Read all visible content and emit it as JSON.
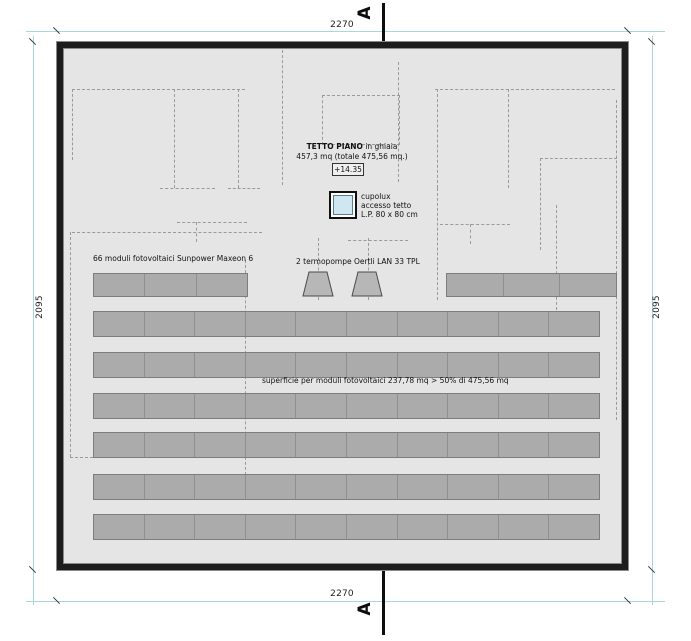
{
  "drawing": {
    "title_bold": "TETTO PIANO",
    "title_rest": " in ghiaia",
    "title_line2": "457,3 mq (totale 475,56 mq.)",
    "elevation": "+14.35",
    "skylight_label": [
      "cupolux",
      "accesso tetto",
      "L.P. 80 x 80 cm"
    ],
    "modules_note": "66 moduli fotovoltaici Sunpower Maxeon 6",
    "heatpump_note": "2 termopompe Oertli LAN 33 TPL",
    "surface_note": "superficie per moduli fotovoltaici 237,78 mq > 50% di  475,56 mq",
    "section_label": "A"
  },
  "dimensions": {
    "top": "2270",
    "bottom": "2270",
    "left": "2095",
    "right": "2095"
  },
  "colors": {
    "dimension_line": "#a9d6d6",
    "dashed_structure": "#9a9a9a",
    "panel_fill": "#ababab",
    "panel_border": "#7d7d7d",
    "roof_fill": "#e5e5e5",
    "wall": "#1d1d1d",
    "skylight_fill": "#cfe6f3"
  },
  "geometry": {
    "rows": [
      {
        "y": 273,
        "h": 24,
        "blocks": [
          {
            "x": 93,
            "w": 155,
            "panels": 3
          },
          {
            "x": 446,
            "w": 171,
            "panels": 3
          }
        ]
      },
      {
        "y": 311,
        "h": 26,
        "blocks": [
          {
            "x": 93,
            "w": 507,
            "panels": 10
          }
        ]
      },
      {
        "y": 352,
        "h": 26,
        "blocks": [
          {
            "x": 93,
            "w": 507,
            "panels": 10
          }
        ]
      },
      {
        "y": 393,
        "h": 26,
        "blocks": [
          {
            "x": 93,
            "w": 507,
            "panels": 10
          }
        ]
      },
      {
        "y": 432,
        "h": 26,
        "blocks": [
          {
            "x": 93,
            "w": 507,
            "panels": 10
          }
        ]
      },
      {
        "y": 474,
        "h": 26,
        "blocks": [
          {
            "x": 93,
            "w": 507,
            "panels": 10
          }
        ]
      },
      {
        "y": 514,
        "h": 26,
        "blocks": [
          {
            "x": 93,
            "w": 507,
            "panels": 10
          }
        ]
      }
    ],
    "dashes": [
      {
        "t": "h",
        "x": 72,
        "y": 89,
        "w": 173
      },
      {
        "t": "v",
        "x": 72,
        "y": 89,
        "h": 71
      },
      {
        "t": "v",
        "x": 174,
        "y": 89,
        "h": 99
      },
      {
        "t": "v",
        "x": 238,
        "y": 89,
        "h": 99
      },
      {
        "t": "h",
        "x": 160,
        "y": 188,
        "w": 55
      },
      {
        "t": "h",
        "x": 228,
        "y": 188,
        "w": 32
      },
      {
        "t": "v",
        "x": 282,
        "y": 50,
        "h": 135
      },
      {
        "t": "r",
        "x": 322,
        "y": 95,
        "w": 78,
        "h": 50
      },
      {
        "t": "v",
        "x": 398,
        "y": 62,
        "h": 120
      },
      {
        "t": "h",
        "x": 435,
        "y": 89,
        "w": 180
      },
      {
        "t": "v",
        "x": 437,
        "y": 89,
        "h": 99
      },
      {
        "t": "v",
        "x": 508,
        "y": 89,
        "h": 99
      },
      {
        "t": "h",
        "x": 540,
        "y": 158,
        "w": 77
      },
      {
        "t": "v",
        "x": 540,
        "y": 158,
        "h": 92
      },
      {
        "t": "v",
        "x": 616,
        "y": 100,
        "h": 320
      },
      {
        "t": "h",
        "x": 177,
        "y": 222,
        "w": 70
      },
      {
        "t": "v",
        "x": 196,
        "y": 222,
        "h": 20
      },
      {
        "t": "h",
        "x": 440,
        "y": 224,
        "w": 70
      },
      {
        "t": "v",
        "x": 470,
        "y": 224,
        "h": 20
      },
      {
        "t": "h",
        "x": 72,
        "y": 232,
        "w": 190
      },
      {
        "t": "v",
        "x": 70,
        "y": 232,
        "h": 225
      },
      {
        "t": "h",
        "x": 70,
        "y": 457,
        "w": 168
      },
      {
        "t": "v",
        "x": 245,
        "y": 260,
        "h": 220
      },
      {
        "t": "v",
        "x": 318,
        "y": 238,
        "h": 62
      },
      {
        "t": "v",
        "x": 368,
        "y": 238,
        "h": 62
      },
      {
        "t": "h",
        "x": 348,
        "y": 240,
        "w": 60
      },
      {
        "t": "v",
        "x": 556,
        "y": 205,
        "h": 105
      },
      {
        "t": "v",
        "x": 437,
        "y": 188,
        "h": 112
      }
    ],
    "heatpumps": [
      {
        "x": 302,
        "y": 271
      },
      {
        "x": 351,
        "y": 271
      }
    ]
  }
}
